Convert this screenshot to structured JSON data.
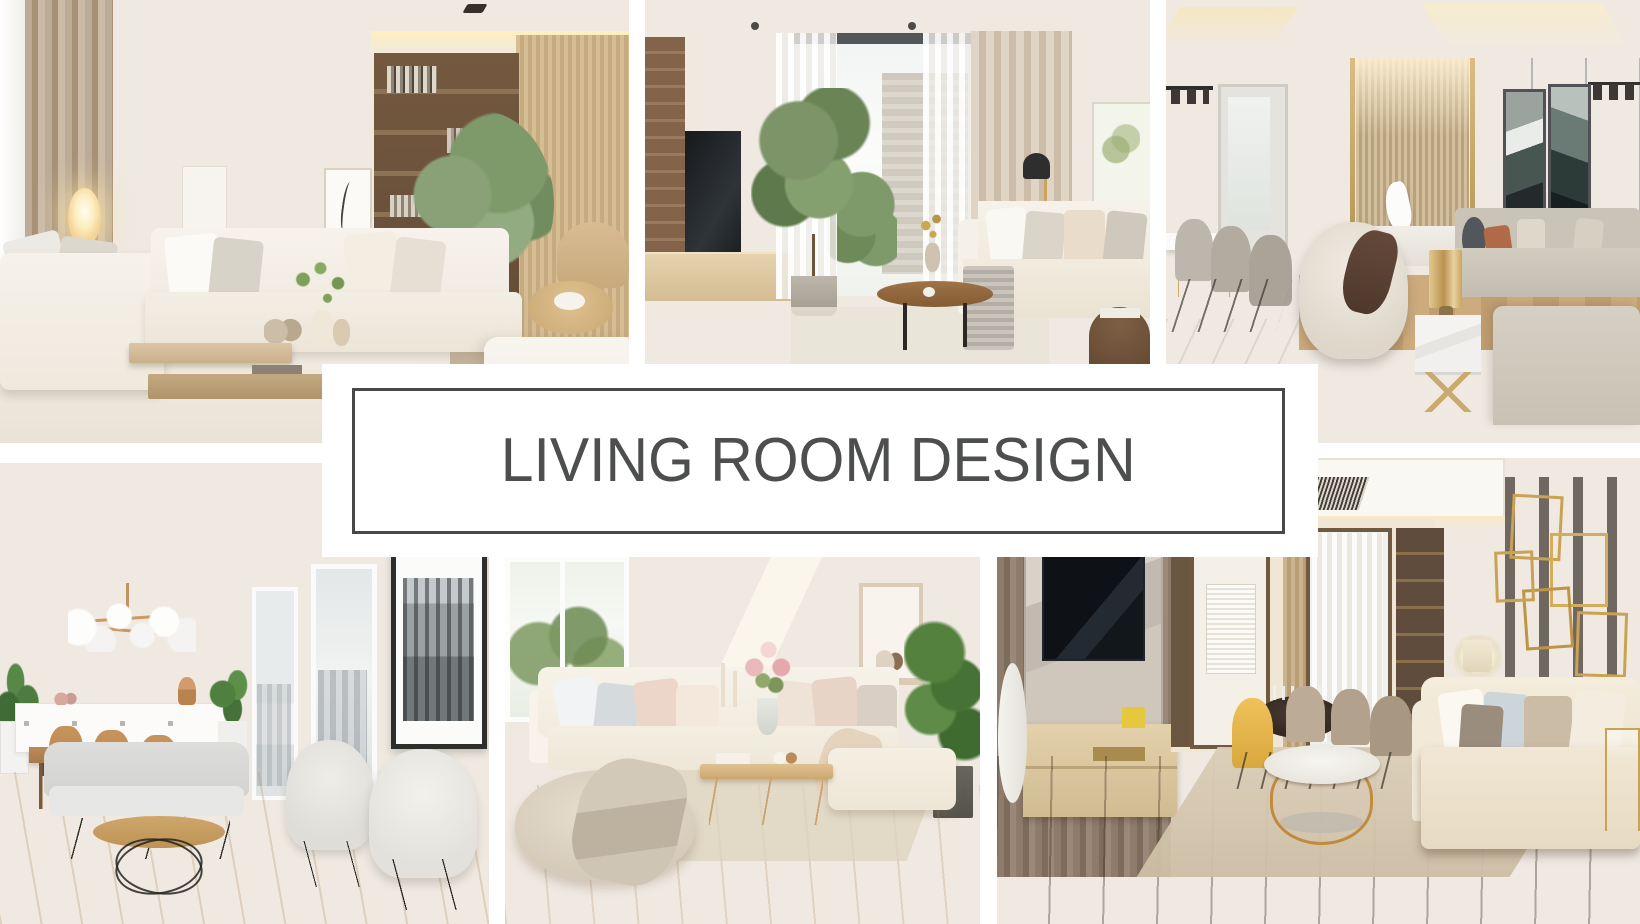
{
  "banner": {
    "title": "LIVING ROOM DESIGN",
    "text_color": "#4d4f4e",
    "border_color": "#46484a",
    "background": "#ffffff"
  },
  "canvas": {
    "background": "#ffffff",
    "width": 1640,
    "height": 924
  },
  "palette": {
    "cream": "#f2ede4",
    "beige": "#d9c7a8",
    "wood": "#b98a5a",
    "dark_wood": "#6b5440",
    "greenery": "#7d9468",
    "warm_glow": "#f7e6c2",
    "gray_wall": "#c9c8cc",
    "gold_accent": "#c9a254",
    "dark_floor": "#997050"
  },
  "tiles": {
    "top_left": {
      "alt": "Bright beige living room with white sectional sofa, glowing oval floor lamp, taupe curtains, wooden two-tier coffee table, dark wood shelving with books and an indoor tree"
    },
    "top_middle": {
      "alt": "Living room with floor-to-ceiling window, sheer curtains, beige drapes, potted ficus tree, wood TV cabinet, black dome floor lamp, round wooden coffee table and white sofa"
    },
    "top_right": {
      "alt": "Elegant gray and gold living room with slatted feature wall, white horse sculpture, dining table with taupe chairs, black pendant lights, dark abstract artworks, cream swivel chair, gold lamp on marble side table and taupe sofa"
    },
    "bottom_left": {
      "alt": "White Scandinavian living room with brass globe chandelier, white sideboard, wooden dining set, city-view windows, black and white skyline artwork, gray loveseat, round coffee table on black wire base and two cream armchairs"
    },
    "bottom_middle": {
      "alt": "Cozy cream corner sofa with blush pillows, garden-view window, pink flower bouquet on light wood coffee table, framed art ledge, potted plant, and a pouf with draped throw blanket on pale oak floor"
    },
    "bottom_right": {
      "alt": "Warm modern living room with gray wood TV wall, marble TV panel, light wood media console, dining nook with yellow and taupe chairs, lit display shelving, gold rectangle wall art, cream sofa with pillows and round gold coffee table on brown plank floor"
    }
  }
}
